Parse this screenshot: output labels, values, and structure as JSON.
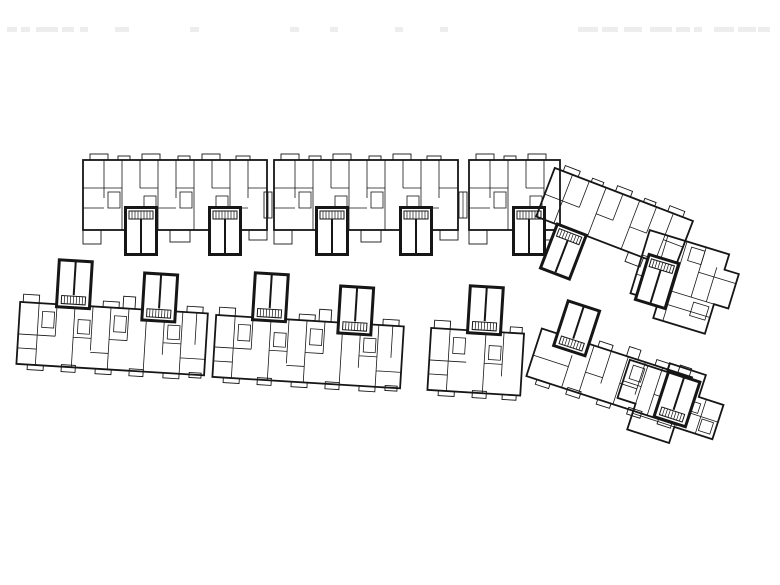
{
  "page": {
    "background": "#ffffff",
    "ink": "#161616",
    "artifact_color": "#ededed"
  },
  "plan": {
    "buildings": [
      {
        "name": "north-row-block-west",
        "module": "band-top",
        "x": 82,
        "y": 152,
        "rotate": 0
      },
      {
        "name": "north-row-block-mid",
        "module": "band-top",
        "x": 273,
        "y": 152,
        "rotate": 0
      },
      {
        "name": "north-row-block-east",
        "module": "band-top-half",
        "x": 468,
        "y": 152,
        "rotate": 0
      },
      {
        "name": "north-row-angled-wing",
        "module": "wing-band-top",
        "x": 556,
        "y": 162,
        "rotate": 21
      },
      {
        "name": "north-row-end-cluster",
        "module": "end-cluster-top",
        "x": 650,
        "y": 226,
        "rotate": 17
      },
      {
        "name": "north-row-link-1",
        "module": "link",
        "x": 264,
        "y": 192,
        "rotate": 0
      },
      {
        "name": "north-row-link-2",
        "module": "link",
        "x": 459,
        "y": 192,
        "rotate": 0
      },
      {
        "name": "south-row-block-west",
        "module": "band-bottom",
        "x": 22,
        "y": 256,
        "rotate": 3.5
      },
      {
        "name": "south-row-block-mid",
        "module": "band-bottom",
        "x": 218,
        "y": 269,
        "rotate": 3.5
      },
      {
        "name": "south-row-block-east",
        "module": "band-bottom-half",
        "x": 433,
        "y": 282,
        "rotate": 3.5
      },
      {
        "name": "south-row-angled-wing",
        "module": "wing-band-bottom",
        "x": 552,
        "y": 294,
        "rotate": 18
      },
      {
        "name": "south-row-end-cluster",
        "module": "end-cluster-bottom",
        "x": 632,
        "y": 350,
        "rotate": 18
      }
    ],
    "faint_marks": [
      {
        "x": 7,
        "y": 27,
        "w": 10,
        "h": 5
      },
      {
        "x": 21,
        "y": 27,
        "w": 9,
        "h": 5
      },
      {
        "x": 36,
        "y": 27,
        "w": 22,
        "h": 5
      },
      {
        "x": 62,
        "y": 27,
        "w": 12,
        "h": 5
      },
      {
        "x": 80,
        "y": 27,
        "w": 8,
        "h": 5
      },
      {
        "x": 115,
        "y": 27,
        "w": 14,
        "h": 5
      },
      {
        "x": 190,
        "y": 27,
        "w": 9,
        "h": 5
      },
      {
        "x": 290,
        "y": 27,
        "w": 9,
        "h": 5
      },
      {
        "x": 330,
        "y": 27,
        "w": 8,
        "h": 5
      },
      {
        "x": 395,
        "y": 27,
        "w": 8,
        "h": 5
      },
      {
        "x": 440,
        "y": 27,
        "w": 8,
        "h": 5
      },
      {
        "x": 578,
        "y": 27,
        "w": 20,
        "h": 5
      },
      {
        "x": 602,
        "y": 27,
        "w": 16,
        "h": 5
      },
      {
        "x": 624,
        "y": 27,
        "w": 18,
        "h": 5
      },
      {
        "x": 650,
        "y": 27,
        "w": 22,
        "h": 5
      },
      {
        "x": 676,
        "y": 27,
        "w": 14,
        "h": 5
      },
      {
        "x": 694,
        "y": 27,
        "w": 8,
        "h": 5
      },
      {
        "x": 714,
        "y": 27,
        "w": 20,
        "h": 5
      },
      {
        "x": 738,
        "y": 27,
        "w": 18,
        "h": 5
      },
      {
        "x": 758,
        "y": 27,
        "w": 12,
        "h": 5
      }
    ]
  }
}
